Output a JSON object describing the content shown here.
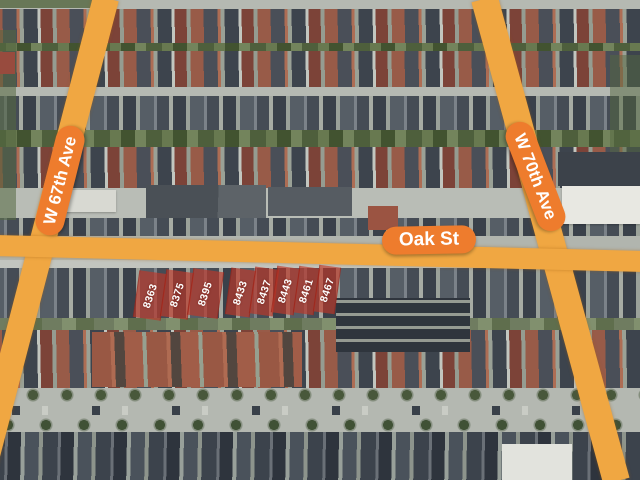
{
  "map": {
    "streets": [
      {
        "name": "W 67th Ave"
      },
      {
        "name": "Oak St"
      },
      {
        "name": "W 70th Ave"
      }
    ],
    "parcels": [
      {
        "number": "8363"
      },
      {
        "number": "8375"
      },
      {
        "number": "8395"
      },
      {
        "number": "8433"
      },
      {
        "number": "8437"
      },
      {
        "number": "8443"
      },
      {
        "number": "8461"
      },
      {
        "number": "8467"
      }
    ],
    "colors": {
      "road_highlight": "#F0A742",
      "label_background": "#EE7C2D",
      "label_text": "#FFFFFF",
      "parcel_highlight": "#C03628",
      "parcel_text": "#FFFFFF"
    }
  }
}
